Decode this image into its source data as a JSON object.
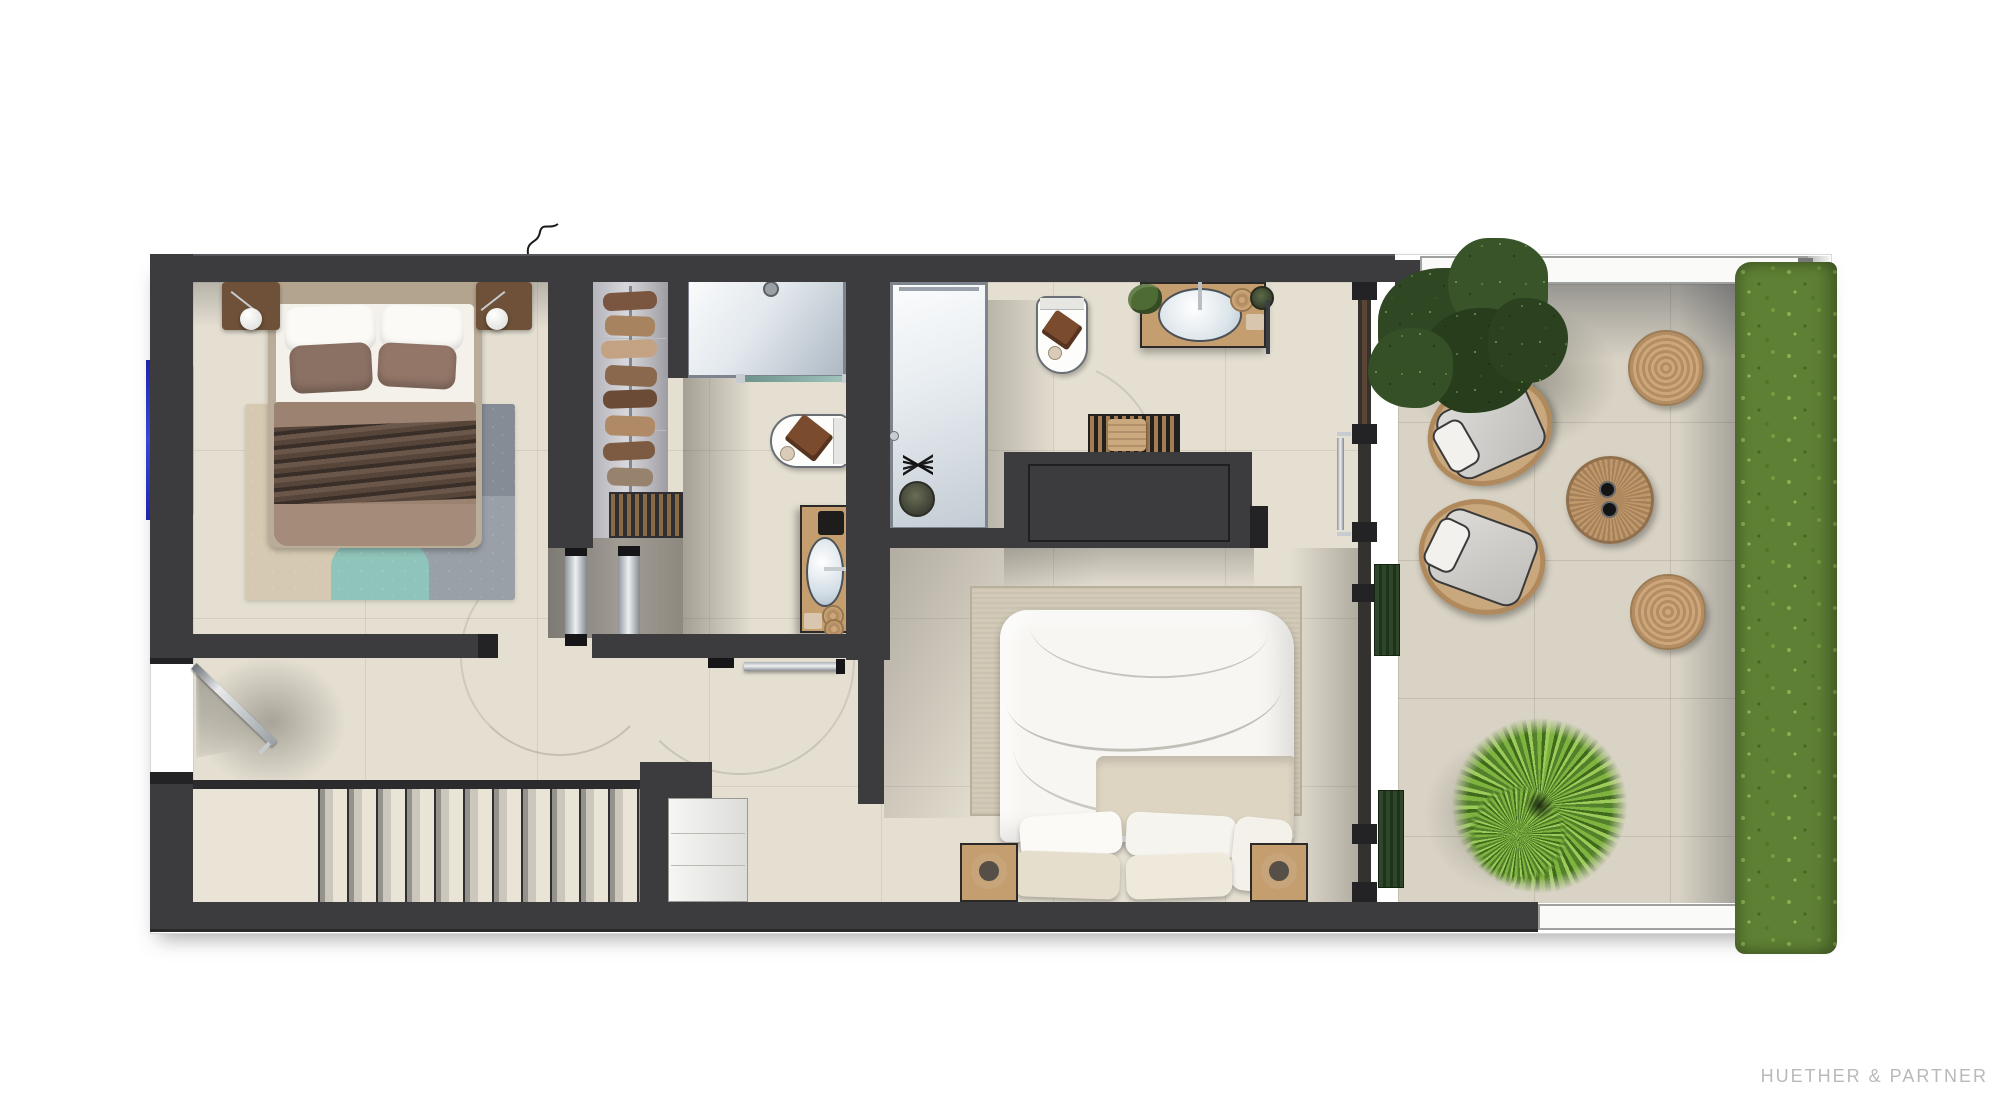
{
  "branding": {
    "studio_label": "HUETHER & PARTNER"
  },
  "palette": {
    "wall": "#3c3c3e",
    "wall_dark": "#232325",
    "floor": "#e4dfd1",
    "floor_gray": "#938f88",
    "terrace_floor": "#d9d3c5",
    "railing_white": "#fafaf8",
    "hedge_green": "#5e8034",
    "tree_green": "#33491f",
    "palm_green": "#79ad3c",
    "wicker": "#c8a87c",
    "cushion_gray": "#d3d2ce",
    "wood_oak": "#c49e6e",
    "wood_dark": "#7b4b2e",
    "window_blue": "#2c36c4",
    "duvet_taupe": "#9c8371",
    "duvet_dark": "#46382e",
    "pillow_brown": "#8b7164",
    "teal_accent": "#8fc4ba",
    "shower_blue": "#b9c4cf",
    "chrome": "#d7dadd",
    "text_gray": "#b9b9b9"
  }
}
